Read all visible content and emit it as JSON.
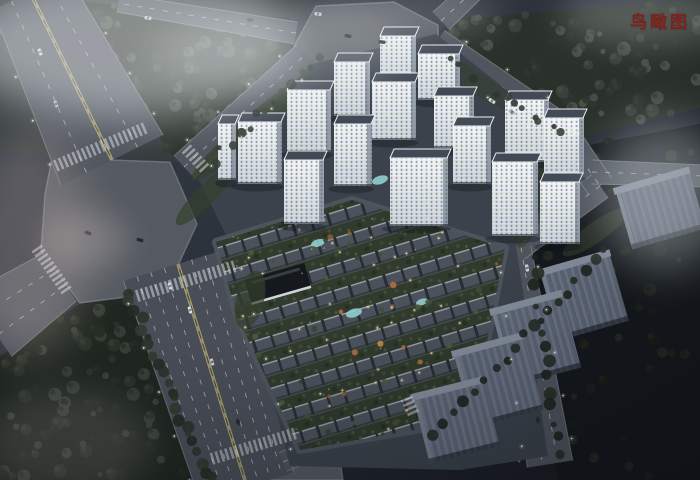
{
  "caption": {
    "text": "鸟瞰图",
    "color": "#7c231d"
  },
  "scene": {
    "background": [
      "#3b424c",
      "#2f353e",
      "#232830",
      "#14181d"
    ],
    "palette": {
      "road": "#4f545d",
      "boulevard": "#484d57",
      "plaza": "#555a61",
      "curb": "#9aa0a7",
      "dash": "rgba(240,244,248,0.5)",
      "yellow": "#c9b45e",
      "site": "#3b424b",
      "grassTint": "#39413a",
      "towerRoof": "#424a56",
      "towerRoofEdge": "#e9edf0",
      "towerSide": "rgba(88,100,116,0.55)",
      "slabTop": "#848d9b",
      "slabRibA": "#5c6576",
      "slabRibB": "#6b7484",
      "pool": "#8fd0cf",
      "clubhouse": "#15191e",
      "clubhouseEdge": "#e4eaee",
      "warmLight": "#f0dfa6",
      "lamp": "#eef0e9",
      "lampHalo": "#f6f2dd",
      "buffer": "#35402e",
      "shrubs": [
        "#41503a",
        "#4a5a40",
        "#374431"
      ],
      "autumn": [
        "#b06f3e",
        "#c98a47",
        "#8e5a34"
      ]
    },
    "roads": [
      {
        "id": "nw-avenue",
        "x1": 30,
        "y1": -8,
        "w1": 82,
        "x2": 112,
        "y2": 160,
        "w2": 114,
        "lanes": 4,
        "yellow": true,
        "lamps": true
      },
      {
        "id": "west-exit",
        "x1": 60,
        "y1": 277,
        "w1": 58,
        "x2": -10,
        "y2": 325,
        "w2": 76,
        "lanes": 3
      },
      {
        "id": "south-boulevard",
        "x1": 178,
        "y1": 264,
        "w1": 114,
        "x2": 247,
        "y2": 487,
        "w2": 98,
        "lanes": 8,
        "yellow": true,
        "lamps": true
      },
      {
        "id": "northwest-link",
        "x1": 184,
        "y1": 167,
        "w1": 30,
        "x2": 306,
        "y2": 54,
        "w2": 26,
        "lanes": 2,
        "lamps": true
      },
      {
        "id": "north-exit",
        "x1": 296,
        "y1": 33,
        "w1": 22,
        "x2": 118,
        "y2": 3,
        "w2": 18,
        "lanes": 2
      },
      {
        "id": "north-spur",
        "x1": 441,
        "y1": 21,
        "w1": 24,
        "x2": 474,
        "y2": -10,
        "w2": 22,
        "lanes": 2
      },
      {
        "id": "northeast-road",
        "x1": 437,
        "y1": 41,
        "w1": 26,
        "x2": 558,
        "y2": 126,
        "w2": 30,
        "lanes": 2,
        "lamps": true
      },
      {
        "id": "east-bend-1",
        "x1": 558,
        "y1": 126,
        "w1": 30,
        "x2": 600,
        "y2": 186,
        "w2": 28,
        "lanes": 2
      },
      {
        "id": "east-bend-2",
        "x1": 600,
        "y1": 186,
        "w1": 28,
        "x2": 516,
        "y2": 248,
        "w2": 28,
        "lanes": 2
      },
      {
        "id": "southeast-road",
        "x1": 516,
        "y1": 248,
        "w1": 30,
        "x2": 550,
        "y2": 464,
        "w2": 46,
        "lanes": 3,
        "lamps": true
      },
      {
        "id": "east-branch",
        "x1": 592,
        "y1": 172,
        "w1": 24,
        "x2": 706,
        "y2": 176,
        "w2": 22,
        "lanes": 2
      },
      {
        "id": "south-link",
        "x1": 283,
        "y1": 462,
        "w1": 20,
        "x2": 432,
        "y2": 397,
        "w2": 20,
        "lanes": 2
      },
      {
        "id": "south-link-2",
        "x1": 432,
        "y1": 397,
        "w1": 20,
        "x2": 526,
        "y2": 452,
        "w2": 24,
        "lanes": 2
      }
    ],
    "plazas": [
      {
        "id": "west-octagon",
        "pts": "52,158 170,162 197,224 166,292 80,303 41,251 45,194"
      },
      {
        "id": "north-octagon",
        "pts": "316,6 394,2 438,25 439,57 392,78 320,74 294,46"
      },
      {
        "id": "south-octagon",
        "pts": "233,451 301,439 340,459 343,480 226,480 221,463"
      }
    ],
    "grass_tint_poly": "0,0 310,0 195,162 0,152",
    "forests": [
      {
        "id": "north-forest",
        "pts": "82,2 290,18 295,45 206,148 172,156 76,8",
        "base": "#2b322c",
        "trees": 70,
        "palette": [
          "#39413a",
          "#2f3730",
          "#465046"
        ]
      },
      {
        "id": "northeast-forest",
        "pts": "444,20 700,0 700,108 577,138 440,58",
        "base": "#2a312b",
        "trees": 85,
        "palette": [
          "#3a423b",
          "#2e3630",
          "#4a524b"
        ]
      },
      {
        "id": "southwest-forest",
        "pts": "0,356 78,305 122,281 208,487 0,487",
        "base": "#1f2620",
        "trees": 95,
        "palette": [
          "#2b322a",
          "#232a22",
          "#394139"
        ]
      },
      {
        "id": "southeast-darkland",
        "pts": "584,146 700,124 700,480 558,480 520,300 543,196",
        "base": "#14181c",
        "trees": 55,
        "palette": [
          "#1d231e",
          "#242b24",
          "#181d18"
        ]
      }
    ],
    "site": {
      "pts": "198,178 312,64 436,34 552,126 516,246 548,456 460,470 290,466 237,258"
    },
    "villa": {
      "pts": "216,242 352,200 505,248 472,420 300,450 237,316",
      "loop_stroke": "#50565e",
      "pools": [
        {
          "x": 380,
          "y": 180,
          "rx": 8,
          "ry": 4
        },
        {
          "x": 318,
          "y": 243,
          "rx": 7,
          "ry": 3.5
        },
        {
          "x": 354,
          "y": 313,
          "rx": 8,
          "ry": 4
        },
        {
          "x": 422,
          "y": 302,
          "rx": 6,
          "ry": 3
        }
      ],
      "clubhouse": {
        "x": 247,
        "y": 271,
        "w": 62,
        "h": 26,
        "rot": -16
      }
    },
    "green_buffers": [
      {
        "x": 252,
        "y": 128,
        "rx": 80,
        "ry": 12,
        "rot": -41,
        "o": 0.75
      },
      {
        "x": 205,
        "y": 196,
        "rx": 40,
        "ry": 10,
        "rot": -45,
        "o": 0.7
      },
      {
        "x": 478,
        "y": 84,
        "rx": 58,
        "ry": 10,
        "rot": 33,
        "o": 0.6
      },
      {
        "x": 534,
        "y": 202,
        "rx": 48,
        "ry": 12,
        "rot": -72,
        "o": 0.65
      },
      {
        "x": 250,
        "y": 300,
        "rx": 14,
        "ry": 30,
        "rot": 14,
        "o": 0.7
      },
      {
        "x": 596,
        "y": 232,
        "rx": 40,
        "ry": 10,
        "rot": -35,
        "o": 0.5
      }
    ],
    "towers": [
      {
        "x": 380,
        "y": 34,
        "w": 36,
        "h": 52
      },
      {
        "x": 334,
        "y": 60,
        "w": 36,
        "h": 56
      },
      {
        "x": 418,
        "y": 52,
        "w": 42,
        "h": 48
      },
      {
        "x": 372,
        "y": 80,
        "w": 44,
        "h": 60
      },
      {
        "x": 287,
        "y": 88,
        "w": 44,
        "h": 64
      },
      {
        "x": 434,
        "y": 94,
        "w": 40,
        "h": 54
      },
      {
        "x": 238,
        "y": 120,
        "w": 44,
        "h": 64
      },
      {
        "x": 218,
        "y": 122,
        "w": 18,
        "h": 58
      },
      {
        "x": 334,
        "y": 122,
        "w": 38,
        "h": 64
      },
      {
        "x": 505,
        "y": 98,
        "w": 44,
        "h": 64
      },
      {
        "x": 544,
        "y": 116,
        "w": 40,
        "h": 60
      },
      {
        "x": 453,
        "y": 124,
        "w": 38,
        "h": 60
      },
      {
        "x": 284,
        "y": 158,
        "w": 40,
        "h": 66
      },
      {
        "x": 390,
        "y": 156,
        "w": 58,
        "h": 70
      },
      {
        "x": 492,
        "y": 160,
        "w": 46,
        "h": 76
      },
      {
        "x": 540,
        "y": 180,
        "w": 40,
        "h": 64
      }
    ],
    "context_buildings": [
      {
        "x": 622,
        "y": 176,
        "w": 76,
        "h": 64,
        "rot": -16
      },
      {
        "x": 548,
        "y": 258,
        "w": 72,
        "h": 74,
        "rot": -16
      },
      {
        "x": 500,
        "y": 298,
        "w": 72,
        "h": 80,
        "rot": -15
      },
      {
        "x": 462,
        "y": 340,
        "w": 72,
        "h": 80,
        "rot": -15
      },
      {
        "x": 420,
        "y": 384,
        "w": 72,
        "h": 72,
        "rot": -14
      }
    ],
    "tree_lines": [
      {
        "x1": 128,
        "y1": 292,
        "x2": 208,
        "y2": 480,
        "n": 22,
        "r": 5,
        "palette": [
          "#2b322a",
          "#323a31",
          "#242b23"
        ]
      },
      {
        "x1": 214,
        "y1": 160,
        "x2": 316,
        "y2": 56,
        "n": 13,
        "r": 4,
        "palette": [
          "#39413a",
          "#2f3730"
        ]
      },
      {
        "x1": 448,
        "y1": 62,
        "x2": 560,
        "y2": 134,
        "n": 13,
        "r": 4,
        "palette": [
          "#3a423b",
          "#2e3630"
        ]
      },
      {
        "x1": 532,
        "y1": 258,
        "x2": 560,
        "y2": 452,
        "n": 14,
        "r": 5,
        "palette": [
          "#1e241f",
          "#262d26"
        ]
      },
      {
        "x1": 606,
        "y1": 248,
        "x2": 436,
        "y2": 434,
        "n": 18,
        "r": 5,
        "palette": [
          "#1e241f",
          "#252c25"
        ]
      }
    ],
    "crosswalks": [
      {
        "x": 100,
        "y": 147,
        "rot": 67,
        "w": 100
      },
      {
        "x": 186,
        "y": 281,
        "rot": 73,
        "w": 104
      },
      {
        "x": 254,
        "y": 446,
        "rot": 73,
        "w": 88
      },
      {
        "x": 195,
        "y": 158,
        "rot": -43,
        "w": 28
      },
      {
        "x": 52,
        "y": 270,
        "rot": -35,
        "w": 56
      },
      {
        "x": 573,
        "y": 128,
        "rot": -8,
        "w": 22
      },
      {
        "x": 410,
        "y": 406,
        "rot": -24,
        "w": 20
      }
    ],
    "cars": [
      {
        "x": 40,
        "y": 52,
        "rot": 70,
        "c": "#d9dee3"
      },
      {
        "x": 56,
        "y": 104,
        "rot": 70,
        "c": "#aeb5bc"
      },
      {
        "x": 148,
        "y": 18,
        "rot": 10,
        "c": "#c8cdd2"
      },
      {
        "x": 250,
        "y": 20,
        "rot": 10,
        "c": "#30353c"
      },
      {
        "x": 190,
        "y": 310,
        "rot": 73,
        "c": "#dde2e6"
      },
      {
        "x": 212,
        "y": 362,
        "rot": 73,
        "c": "#c5cacf"
      },
      {
        "x": 238,
        "y": 422,
        "rot": 73,
        "c": "#2e333a"
      },
      {
        "x": 170,
        "y": 286,
        "rot": 73,
        "c": "#d5dade"
      },
      {
        "x": 492,
        "y": 101,
        "rot": 33,
        "c": "#d8dde2"
      },
      {
        "x": 512,
        "y": 112,
        "rot": 33,
        "c": "#b8bec4"
      },
      {
        "x": 527,
        "y": 268,
        "rot": 80,
        "c": "#cfd4d9"
      },
      {
        "x": 538,
        "y": 420,
        "rot": 82,
        "c": "#2f343b"
      },
      {
        "x": 318,
        "y": 14,
        "rot": 8,
        "c": "#c9ced3"
      },
      {
        "x": 88,
        "y": 233,
        "rot": 20,
        "c": "#23282e"
      },
      {
        "x": 140,
        "y": 240,
        "rot": 15,
        "c": "#262b31"
      },
      {
        "x": 348,
        "y": 36,
        "rot": 10,
        "c": "#22262c"
      },
      {
        "x": 382,
        "y": 42,
        "rot": 8,
        "c": "#2a2f35"
      }
    ],
    "clouds": [
      {
        "x": -40,
        "y": -30,
        "w": 340,
        "h": 150,
        "c": "#e6eaec",
        "o": 0.5,
        "b": 22
      },
      {
        "x": 150,
        "y": 10,
        "w": 260,
        "h": 80,
        "c": "#dfe4e7",
        "o": 0.28,
        "b": 18
      },
      {
        "x": 300,
        "y": -10,
        "w": 200,
        "h": 50,
        "c": "#ffffff",
        "o": 0.18,
        "b": 16
      },
      {
        "x": 600,
        "y": 120,
        "w": 130,
        "h": 150,
        "c": "#cdd5d9",
        "o": 0.42,
        "b": 22
      },
      {
        "x": 560,
        "y": -15,
        "w": 170,
        "h": 60,
        "c": "#dfe4e7",
        "o": 0.25,
        "b": 16
      },
      {
        "x": -30,
        "y": 130,
        "w": 120,
        "h": 230,
        "c": "#e6cfc8",
        "o": 0.22,
        "b": 20
      },
      {
        "x": -20,
        "y": 390,
        "w": 170,
        "h": 110,
        "c": "#dcd3d6",
        "o": 0.16,
        "b": 18
      },
      {
        "x": 40,
        "y": 210,
        "w": 90,
        "h": 60,
        "c": "#eedcd6",
        "o": 0.2,
        "b": 14
      }
    ]
  }
}
